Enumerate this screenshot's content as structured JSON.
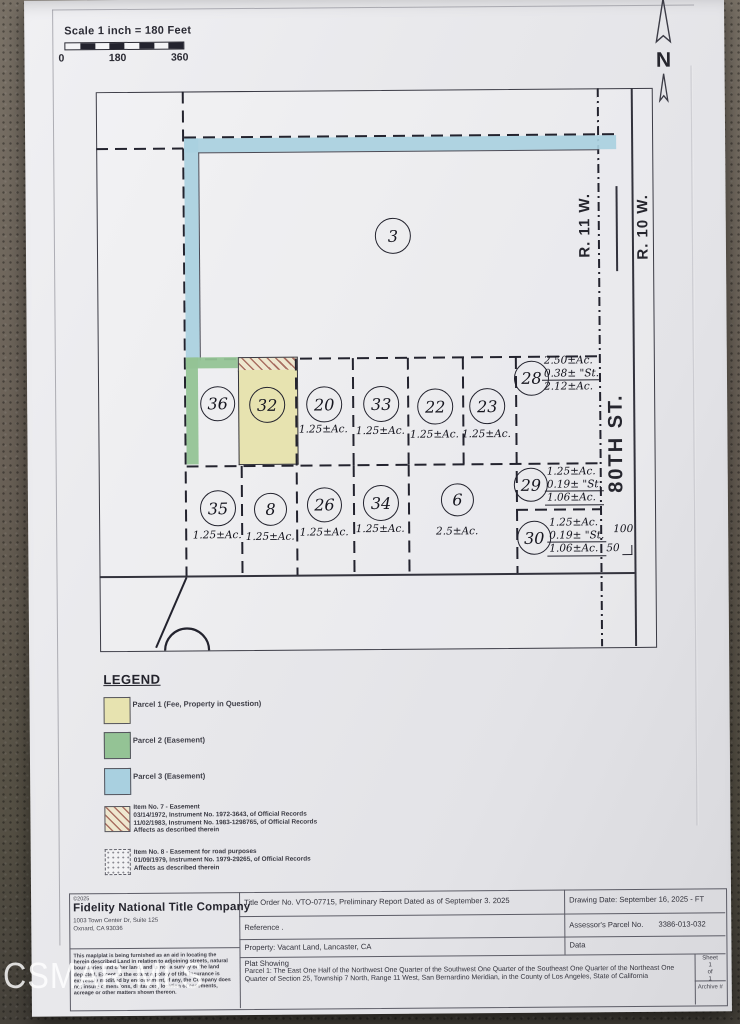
{
  "colors": {
    "parcel1_fill": "#e7e3b0",
    "parcel2_fill": "#94c395",
    "parcel3_fill": "#a9d0e0",
    "hatch_line": "#a96f62"
  },
  "scale": {
    "label": "Scale  1 inch = 180 Feet",
    "tick0": "0",
    "tick180": "180",
    "tick360": "360"
  },
  "compass": {
    "label": "N"
  },
  "map": {
    "range_left": "R. 11 W.",
    "range_right": "R. 10 W.",
    "street": "80TH ST.",
    "dim_100": "100",
    "dim_50": "50",
    "parcels": {
      "p3": {
        "num": "3"
      },
      "p36": {
        "num": "36"
      },
      "p32": {
        "num": "32"
      },
      "p20": {
        "num": "20",
        "acreage": "1.25±Ac."
      },
      "p33": {
        "num": "33",
        "acreage": "1.25±Ac."
      },
      "p22": {
        "num": "22",
        "acreage": "1.25±Ac."
      },
      "p23": {
        "num": "23",
        "acreage": "1.25±Ac."
      },
      "p28": {
        "num": "28",
        "line1": "2.50±Ac.",
        "line2": "0.38± \"St.",
        "line3": "2.12±Ac."
      },
      "p35": {
        "num": "35",
        "acreage": "1.25±Ac."
      },
      "p8": {
        "num": "8",
        "acreage": "1.25±Ac."
      },
      "p26": {
        "num": "26",
        "acreage": "1.25±Ac."
      },
      "p34": {
        "num": "34",
        "acreage": "1.25±Ac."
      },
      "p6": {
        "num": "6",
        "acreage": "2.5±Ac."
      },
      "p29": {
        "num": "29",
        "line1": "1.25±Ac.",
        "line2": "0.19± \"St.",
        "line3": "1.06±Ac."
      },
      "p30": {
        "num": "30",
        "line1": "1.25±Ac.",
        "line2": "0.19± \"St.",
        "line3": "1.06±Ac."
      }
    }
  },
  "legend": {
    "title": "LEGEND",
    "parcel1": "Parcel 1 (Fee, Property in Question)",
    "parcel2": "Parcel 2 (Easement)",
    "parcel3": "Parcel 3 (Easement)",
    "item7_l1": "Item No. 7 -  Easement",
    "item7_l2": "03/14/1972, Instrument No. 1972-3643, of Official Records",
    "item7_l3": "11/02/1983, Instrument No. 1983-1298765, of Official Records",
    "item7_l4": "Affects as described therein",
    "item8_l1": "Item No. 8 -  Easement for road purposes",
    "item8_l2": "01/09/1979, Instrument No. 1979-29265, of Official Records",
    "item8_l3": "Affects as described therein"
  },
  "title_block": {
    "copyright": "©2025",
    "company": "Fidelity National Title Company",
    "address1": "1003 Town Center Dr, Suite 125",
    "address2": "Oxnard, CA 93036",
    "disclaimer": "This map/plat is being furnished as an aid in locating the herein described Land in relation to adjoining streets, natural boundaries and other land, and is not a survey of the land depicted. Except to the extent a policy of title insurance is expressly modified by endorsement, if any, the Company does not insure dimensions, distances, location of easements, acreage or other matters shown thereon.",
    "title_order": "Title Order No. VTO-07715, Preliminary Report Dated as of September 3. 2025",
    "reference": "Reference .",
    "property": "Property: Vacant Land, Lancaster, CA",
    "drawing_date": "Drawing Date: September 16, 2025 - FT",
    "apn_label": "Assessor's Parcel No.",
    "apn_value": "3386-013-032",
    "data_label": "Data",
    "plat_showing": "Plat Showing",
    "legal": "Parcel 1: The East One Half of the Northwest One Quarter of the Southwest One Quarter of the Southeast One Quarter of the Northeast One Quarter of Section 25, Township 7 North, Range 11 West, San Bernardino Meridian, in the County of Los Angeles, State of California",
    "sheet_label": "Sheet",
    "sheet_num": "1",
    "sheet_of": "of",
    "sheet_total": "1",
    "archive": "Archive #"
  },
  "watermark": "CSMAR MLS"
}
